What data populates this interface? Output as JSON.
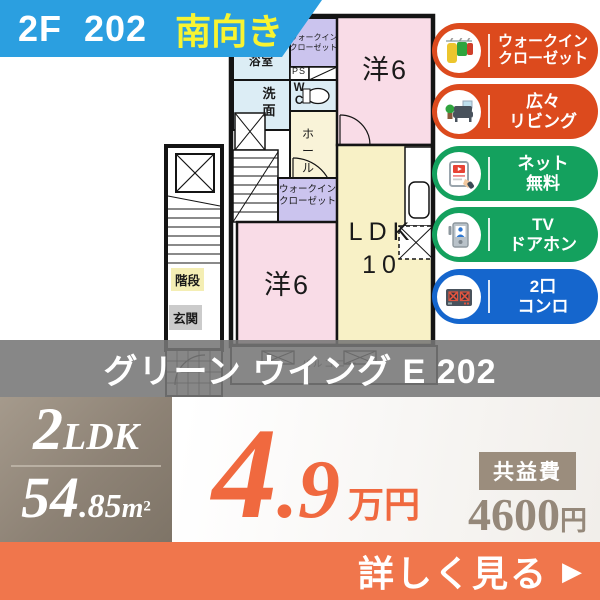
{
  "header": {
    "unit_label": "2F  202",
    "facing_label": "南向き"
  },
  "plan": {
    "bath": "浴室",
    "washroom": "洗面",
    "wc": "WC",
    "ps": "PS",
    "closet_upper": [
      "ウォークイン",
      "クローゼット"
    ],
    "closet_lower": [
      "ウォークイン",
      "クローゼット"
    ],
    "western_top": "洋6",
    "western_bottom": "洋6",
    "ldk_label": "LDK",
    "ldk_size": "10",
    "hall": "ホール",
    "stairs": "階段",
    "entrance": "玄関",
    "balcony": "バルコニー"
  },
  "features": [
    {
      "icon": "walkin-closet-icon",
      "lines": [
        "ウォークイン",
        "クローゼット"
      ],
      "color": "#dc4a1d"
    },
    {
      "icon": "sofa-icon",
      "lines": [
        "広々",
        "リビング"
      ],
      "color": "#dc4a1d"
    },
    {
      "icon": "tablet-icon",
      "lines": [
        "ネット",
        "無料"
      ],
      "color": "#14a15e"
    },
    {
      "icon": "doorphone-icon",
      "lines": [
        "TV",
        "ドアホン"
      ],
      "color": "#14a15e"
    },
    {
      "icon": "stove-icon",
      "lines": [
        "2口",
        "コンロ"
      ],
      "color": "#1566cd"
    }
  ],
  "property_name": "グリーン ウイング E 202",
  "summary": {
    "layout_number": "2",
    "layout_type": "LDK",
    "area_int": "54",
    "area_dec": ".85",
    "area_unit": "m",
    "area_sup": "2",
    "rent_int": "4",
    "rent_dec": ".9",
    "rent_unit": "万円",
    "fee_label": "共益費",
    "fee_value": "4600",
    "fee_unit": "円"
  },
  "cta": {
    "label": "詳しく見る",
    "arrow": "▶"
  },
  "colors": {
    "banner_blue": "#2b9fe0",
    "facing_yellow": "#f8f431",
    "feature_red": "#dc4a1d",
    "feature_green": "#14a15e",
    "feature_blue": "#1566cd",
    "title_band_gray": "#767676",
    "summary_box_brown": "#95887a",
    "price_orange": "#f0693f",
    "cta_orange": "#f0764c",
    "room_pink": "#f9dce7",
    "room_cream": "#f8f1c6",
    "room_blue": "#dcedf5",
    "room_purple": "#cbc4ee"
  }
}
